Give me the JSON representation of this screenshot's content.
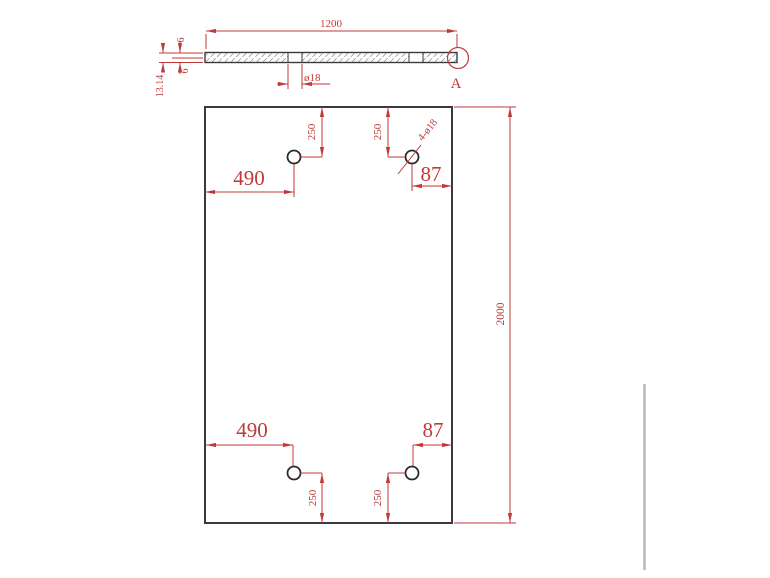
{
  "colors": {
    "dimension": "#c03a3a",
    "outline": "#3a3a3a",
    "hatch": "#4a4a4a",
    "hole_stroke": "#2a2a2a",
    "artifact_gray": "#b9b9b9",
    "background": "#ffffff"
  },
  "section_view": {
    "length": "1200",
    "top_skin_thickness": "6",
    "bottom_skin_thickness": "6",
    "overall_thickness": "13.14",
    "hole_diameter": "ø18",
    "detail_marker": "A"
  },
  "plan_view": {
    "overall_height": "2000",
    "hole_callout": "4-ø18",
    "top_left_hole_x": "490",
    "top_left_hole_y": "250",
    "top_right_hole_x": "87",
    "top_right_hole_y": "250",
    "bottom_left_hole_x": "490",
    "bottom_left_hole_y": "250",
    "bottom_right_hole_x": "87",
    "bottom_right_hole_y": "250"
  }
}
